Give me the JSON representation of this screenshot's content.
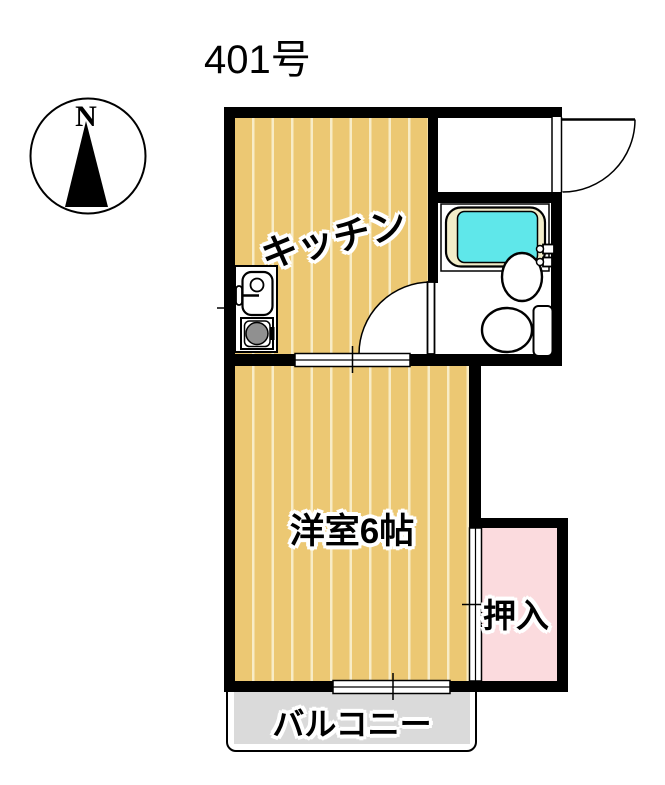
{
  "title": "401号",
  "compass": {
    "label": "N"
  },
  "rooms": {
    "kitchen": {
      "label": "キッチン"
    },
    "western_room": {
      "label": "洋室6帖"
    },
    "closet": {
      "label": "押入"
    },
    "balcony": {
      "label": "バルコニー"
    }
  },
  "colors": {
    "floor": "#ECC873",
    "floor-stripe": "#F8ECC6",
    "closet-pink": "#FBDBDE",
    "balcony-gray": "#DADADA",
    "tub-water": "#5FE7EA",
    "tub-rim": "#F2EDC9",
    "burner-gray": "#909090",
    "wall-black": "#000000"
  }
}
